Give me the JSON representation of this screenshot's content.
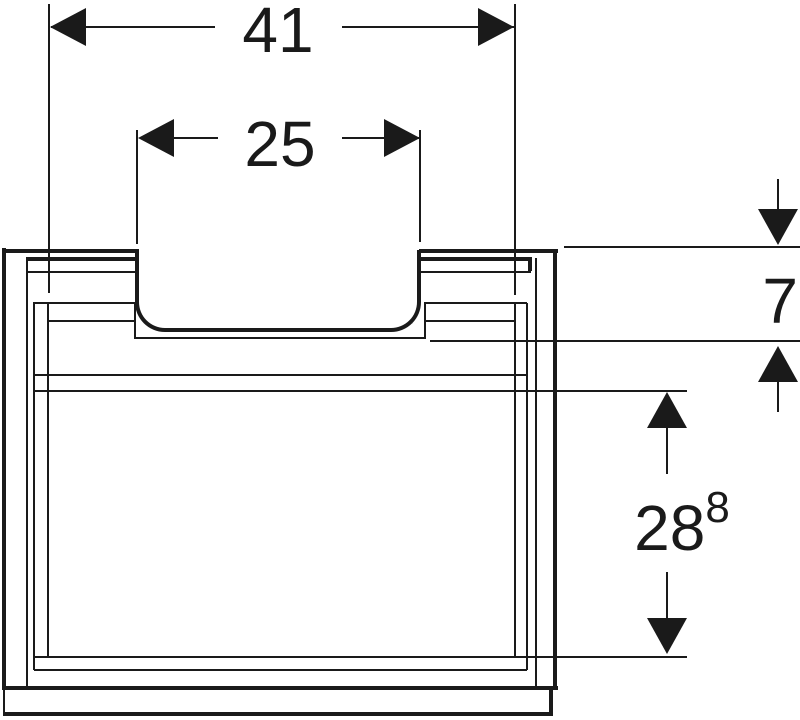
{
  "drawing": {
    "type": "furniture-dimension-diagram",
    "description": "Front elevation technical drawing of a vanity cabinet with top handle recess, two drawer fronts and plinth",
    "line_color": "#1a1a1a",
    "background_color": "#ffffff"
  },
  "dimensions": {
    "overall_width": {
      "value": "41"
    },
    "recess_width": {
      "value": "25"
    },
    "apron_height": {
      "value": "7"
    },
    "drawer_front_height": {
      "value": "28",
      "decimal_superscript": "8"
    }
  }
}
